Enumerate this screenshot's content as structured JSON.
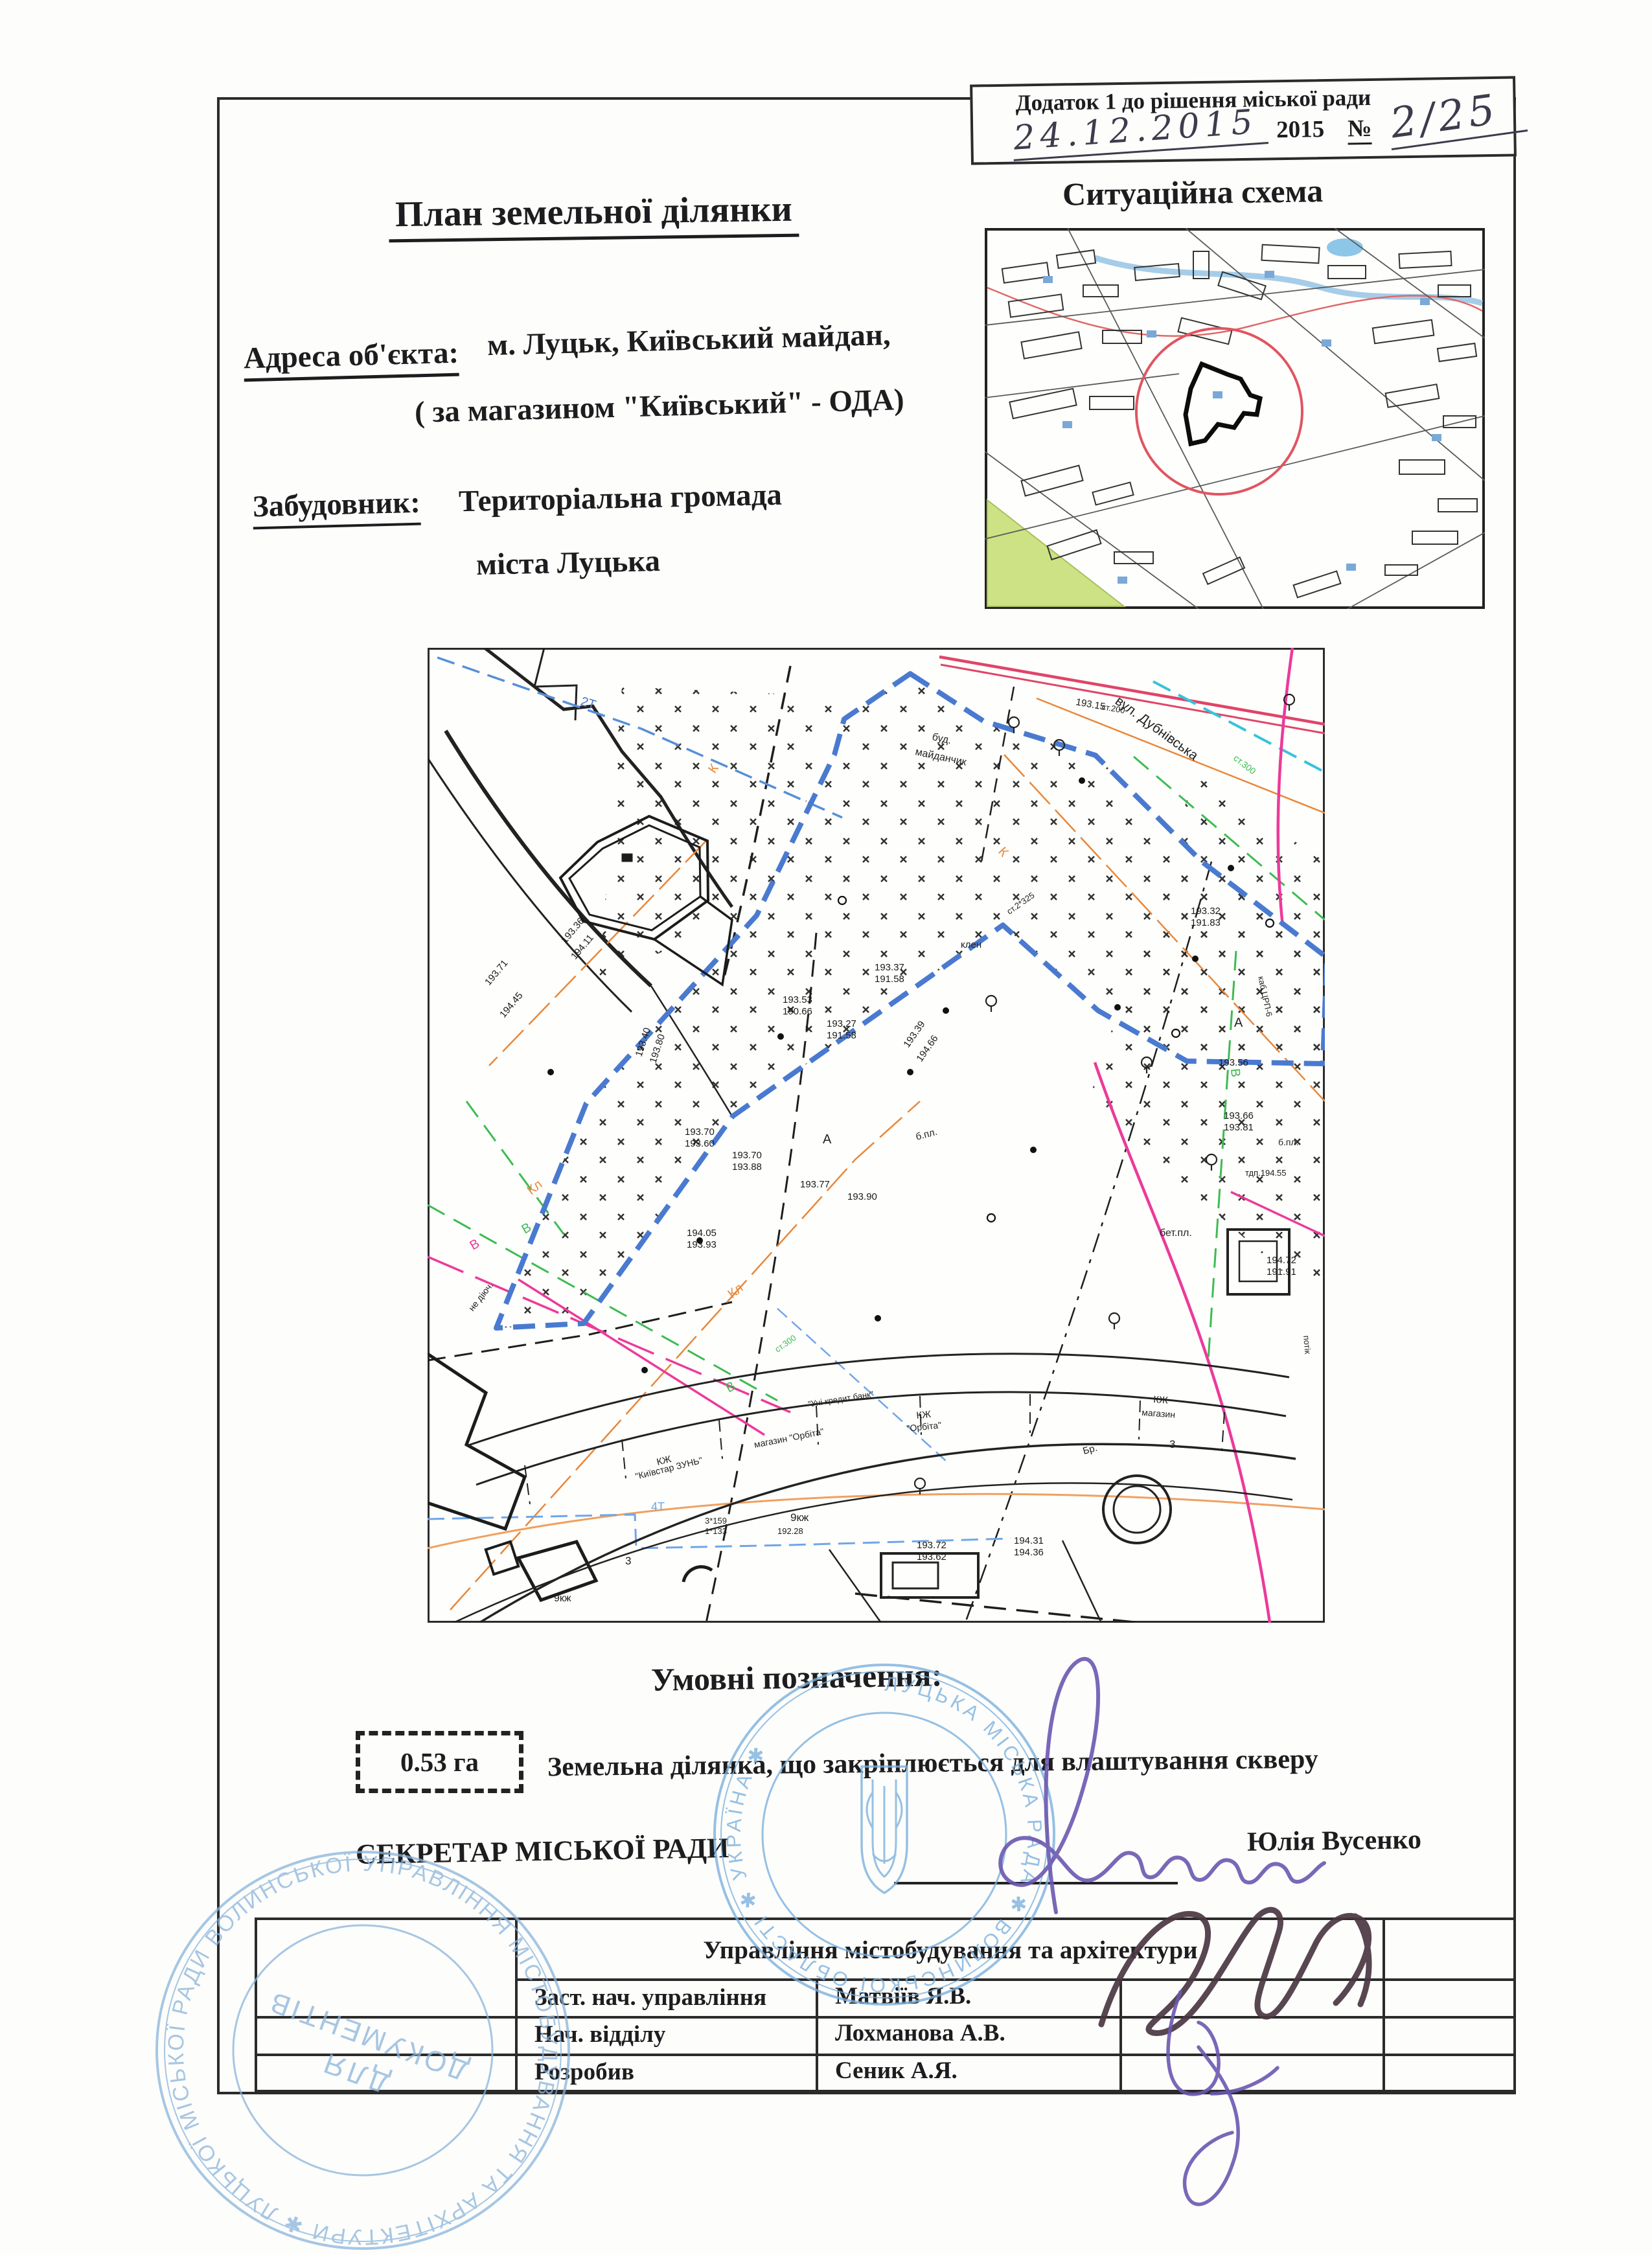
{
  "appendix": {
    "line1": "Додаток 1 до рішення міської ради",
    "date_handwritten": "24.12.2015",
    "year": "2015",
    "no_sign": "№",
    "number_handwritten": "2/25"
  },
  "header": {
    "title": "План земельної ділянки",
    "address_label": "Адреса об'єкта:",
    "address_value_line1": "м. Луцьк, Київський майдан,",
    "address_value_line2": "( за магазином \"Київський\" - ОДА)",
    "developer_label": "Забудовник:",
    "developer_value_line1": "Територіальна громада",
    "developer_value_line2": "міста Луцька",
    "situation_title": "Ситуаційна схема"
  },
  "legend": {
    "title": "Умовні позначення:",
    "area_value": "0.53 га",
    "description": "Земельна ділянка, що закріплюється для влаштування скверу",
    "secretary_label": "СЕКРЕТАР МІСЬКОЇ РАДИ",
    "secretary_name": "Юлія Вусенко"
  },
  "table": {
    "header": "Управління містобудування та архітектури",
    "rows": [
      {
        "position": "Заст. нач. управління",
        "name": "Матвіїв Я.В."
      },
      {
        "position": "Нач. відділу",
        "name": "Лохманова А.В."
      },
      {
        "position": "Розробив",
        "name": "Сеник А.Я."
      }
    ]
  },
  "stamps": {
    "council_ring": "ЛУЦЬКА  МІСЬКА  РАДА  ✱  ВОЛИНСЬКОЇ  ОБЛАСТІ  ✱  УКРАЇНА  ✱",
    "dept_ring": "УПРАВЛІННЯ МІСТОБУДУВАННЯ ТА АРХІТЕКТУРИ ✱ ЛУЦЬКОЇ МІСЬКОЇ РАДИ ВОЛИНСЬКОЇ ОБЛАСТІ ✱",
    "dept_center_line1": "ДЛЯ",
    "dept_center_line2": "ДОКУМЕНТІВ"
  },
  "map": {
    "street": "вул. Дубнівська",
    "labels": [
      "2Т",
      "К",
      "Кл",
      "Кл",
      "К",
      "В",
      "В",
      "В",
      "В",
      "4Т",
      "А",
      "А",
      "3",
      "3",
      "Бр.",
      "б.пл.",
      "бет.пл.",
      "буд.",
      "майданчик",
      "клен",
      "не діюч.",
      "КЖ",
      "\"Київстар ЗУНЬ\"",
      "магазин \"Орбіта\"",
      "КЖ",
      "\"Орбіта\"",
      "\"Уні кредит банк\"",
      "КЖ",
      "магазин",
      "9кж",
      "9кж",
      "ст.300",
      "ст.2*325",
      "каб.ЦРП-6",
      "потік",
      "3*159",
      "1*133",
      "ст.300",
      "ст.200",
      "б.пл."
    ],
    "elevations": [
      "193.37",
      "191.58",
      "193.27",
      "191.58",
      "193.53",
      "190.66",
      "193.40",
      "193.80",
      "193.39",
      "194.66",
      "194.05",
      "193.93",
      "194.45",
      "194.11",
      "193.36",
      "193.71",
      "193.70",
      "193.60",
      "193.70",
      "193.88",
      "193.77",
      "193.90",
      "194.31",
      "194.36",
      "194.72",
      "191.91",
      "193.56",
      "193.66",
      "193.81",
      "тдп.194.55",
      "193.32",
      "191.83",
      "193.15",
      "193.72",
      "193.62",
      "192.28"
    ]
  },
  "colors": {
    "ink": "#1d1d1f",
    "stamp_blue": "#7ab0de",
    "signature_purple": "#6a58b0",
    "signature_dark": "#4a3642",
    "boundary_blue": "#4a7ad0",
    "utility_orange": "#e8873a",
    "utility_green": "#3dbb52",
    "utility_magenta": "#ec3a9a",
    "utility_crimson": "#e04468",
    "utility_cyan": "#38c2dc",
    "utility_lightblue": "#6fa6e8",
    "sitmap_green_area": "#cde284",
    "sitmap_circle_red": "#e05560"
  }
}
